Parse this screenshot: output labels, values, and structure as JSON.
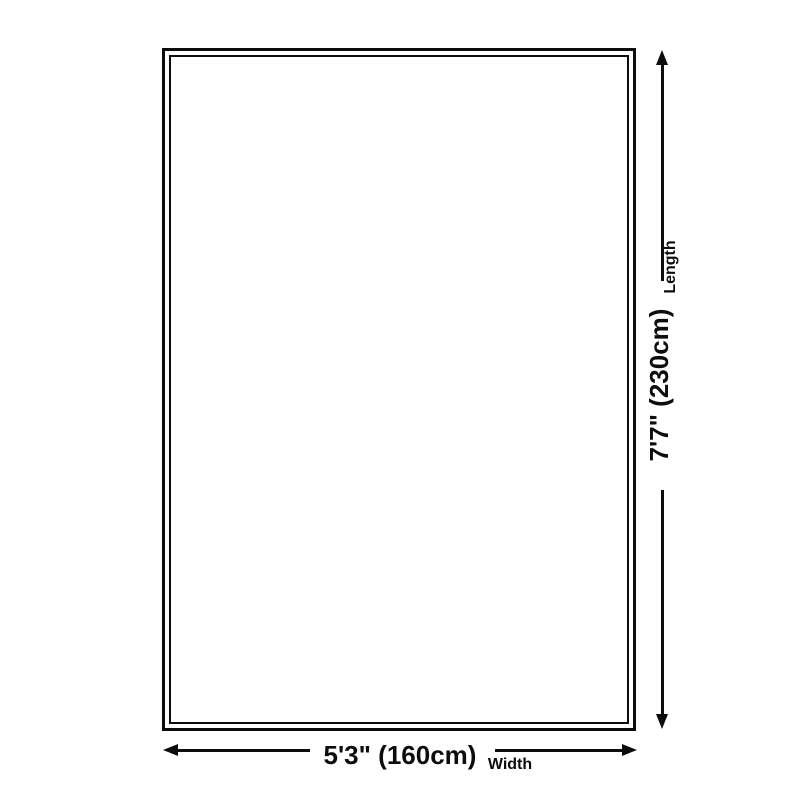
{
  "diagram": {
    "title": "rug size diagram",
    "length": {
      "value": "7'7\" (230cm)",
      "label": "Length"
    },
    "width": {
      "value": "5'3\" (160cm)",
      "label": "Width"
    }
  },
  "colors": {
    "line": "#0d0d0d",
    "background": "#ffffff"
  }
}
